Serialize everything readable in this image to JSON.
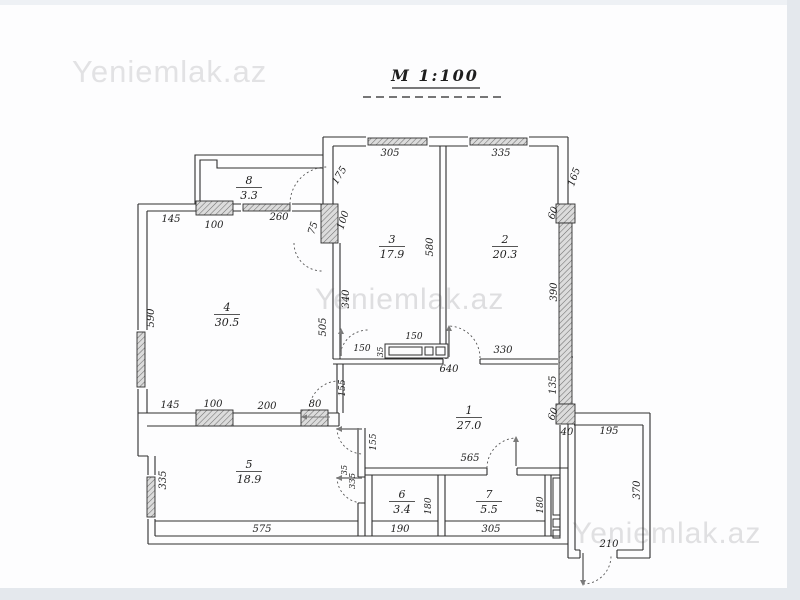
{
  "page": {
    "scale_title": "M 1:100",
    "watermark": "Yeniemlak.az"
  },
  "rooms": [
    {
      "number": "8",
      "area": "3.3",
      "x": 249,
      "y": 184
    },
    {
      "number": "3",
      "area": "17.9",
      "x": 392,
      "y": 243
    },
    {
      "number": "2",
      "area": "20.3",
      "x": 505,
      "y": 243
    },
    {
      "number": "4",
      "area": "30.5",
      "x": 227,
      "y": 311
    },
    {
      "number": "1",
      "area": "27.0",
      "x": 469,
      "y": 414
    },
    {
      "number": "5",
      "area": "18.9",
      "x": 249,
      "y": 468
    },
    {
      "number": "6",
      "area": "3.4",
      "x": 402,
      "y": 498
    },
    {
      "number": "7",
      "area": "5.5",
      "x": 489,
      "y": 498
    }
  ],
  "dimensions": [
    {
      "label": "305",
      "x": 390,
      "y": 156,
      "r": 0
    },
    {
      "label": "335",
      "x": 501,
      "y": 156,
      "r": 0
    },
    {
      "label": "165",
      "x": 577,
      "y": 178,
      "r": -70
    },
    {
      "label": "60",
      "x": 556,
      "y": 214,
      "r": -70
    },
    {
      "label": "390",
      "x": 557,
      "y": 292,
      "r": -90
    },
    {
      "label": "135",
      "x": 556,
      "y": 385,
      "r": -90
    },
    {
      "label": "60",
      "x": 556,
      "y": 415,
      "r": -70
    },
    {
      "label": "40",
      "x": 567,
      "y": 435,
      "r": 0
    },
    {
      "label": "580",
      "x": 433,
      "y": 247,
      "r": -90
    },
    {
      "label": "175",
      "x": 342,
      "y": 177,
      "r": -58
    },
    {
      "label": "75",
      "x": 316,
      "y": 229,
      "r": -72
    },
    {
      "label": "100",
      "x": 346,
      "y": 221,
      "r": -72
    },
    {
      "label": "145",
      "x": 171,
      "y": 222,
      "r": 0
    },
    {
      "label": "100",
      "x": 214,
      "y": 228,
      "r": 0
    },
    {
      "label": "260",
      "x": 279,
      "y": 220,
      "r": 0
    },
    {
      "label": "590",
      "x": 154,
      "y": 318,
      "r": -90
    },
    {
      "label": "340",
      "x": 349,
      "y": 299,
      "r": -90
    },
    {
      "label": "505",
      "x": 326,
      "y": 327,
      "r": -90
    },
    {
      "label": "150",
      "x": 362,
      "y": 351,
      "r": 0,
      "s": 9
    },
    {
      "label": "35",
      "x": 383,
      "y": 352,
      "r": -90,
      "s": 8.5
    },
    {
      "label": "150",
      "x": 414,
      "y": 339,
      "r": 0,
      "s": 9
    },
    {
      "label": "640",
      "x": 449,
      "y": 372,
      "r": 0
    },
    {
      "label": "330",
      "x": 503,
      "y": 353,
      "r": 0
    },
    {
      "label": "145",
      "x": 170,
      "y": 408,
      "r": 0
    },
    {
      "label": "100",
      "x": 213,
      "y": 407,
      "r": 0
    },
    {
      "label": "200",
      "x": 267,
      "y": 409,
      "r": 0
    },
    {
      "label": "80",
      "x": 315,
      "y": 407,
      "r": 0
    },
    {
      "label": "155",
      "x": 345,
      "y": 388,
      "r": -90,
      "s": 9
    },
    {
      "label": "155",
      "x": 376,
      "y": 442,
      "r": -90,
      "s": 9
    },
    {
      "label": "335",
      "x": 166,
      "y": 480,
      "r": -90
    },
    {
      "label": "35",
      "x": 347,
      "y": 470,
      "r": -90,
      "s": 8
    },
    {
      "label": "335",
      "x": 355,
      "y": 481,
      "r": -90,
      "s": 8.5
    },
    {
      "label": "575",
      "x": 262,
      "y": 532,
      "r": 0
    },
    {
      "label": "565",
      "x": 470,
      "y": 461,
      "r": 0
    },
    {
      "label": "190",
      "x": 400,
      "y": 532,
      "r": 0
    },
    {
      "label": "180",
      "x": 431,
      "y": 506,
      "r": -90,
      "s": 9
    },
    {
      "label": "305",
      "x": 491,
      "y": 532,
      "r": 0
    },
    {
      "label": "180",
      "x": 543,
      "y": 505,
      "r": -90,
      "s": 9
    },
    {
      "label": "195",
      "x": 609,
      "y": 434,
      "r": 0
    },
    {
      "label": "370",
      "x": 640,
      "y": 490,
      "r": -90
    },
    {
      "label": "210",
      "x": 609,
      "y": 547,
      "r": 0
    }
  ]
}
